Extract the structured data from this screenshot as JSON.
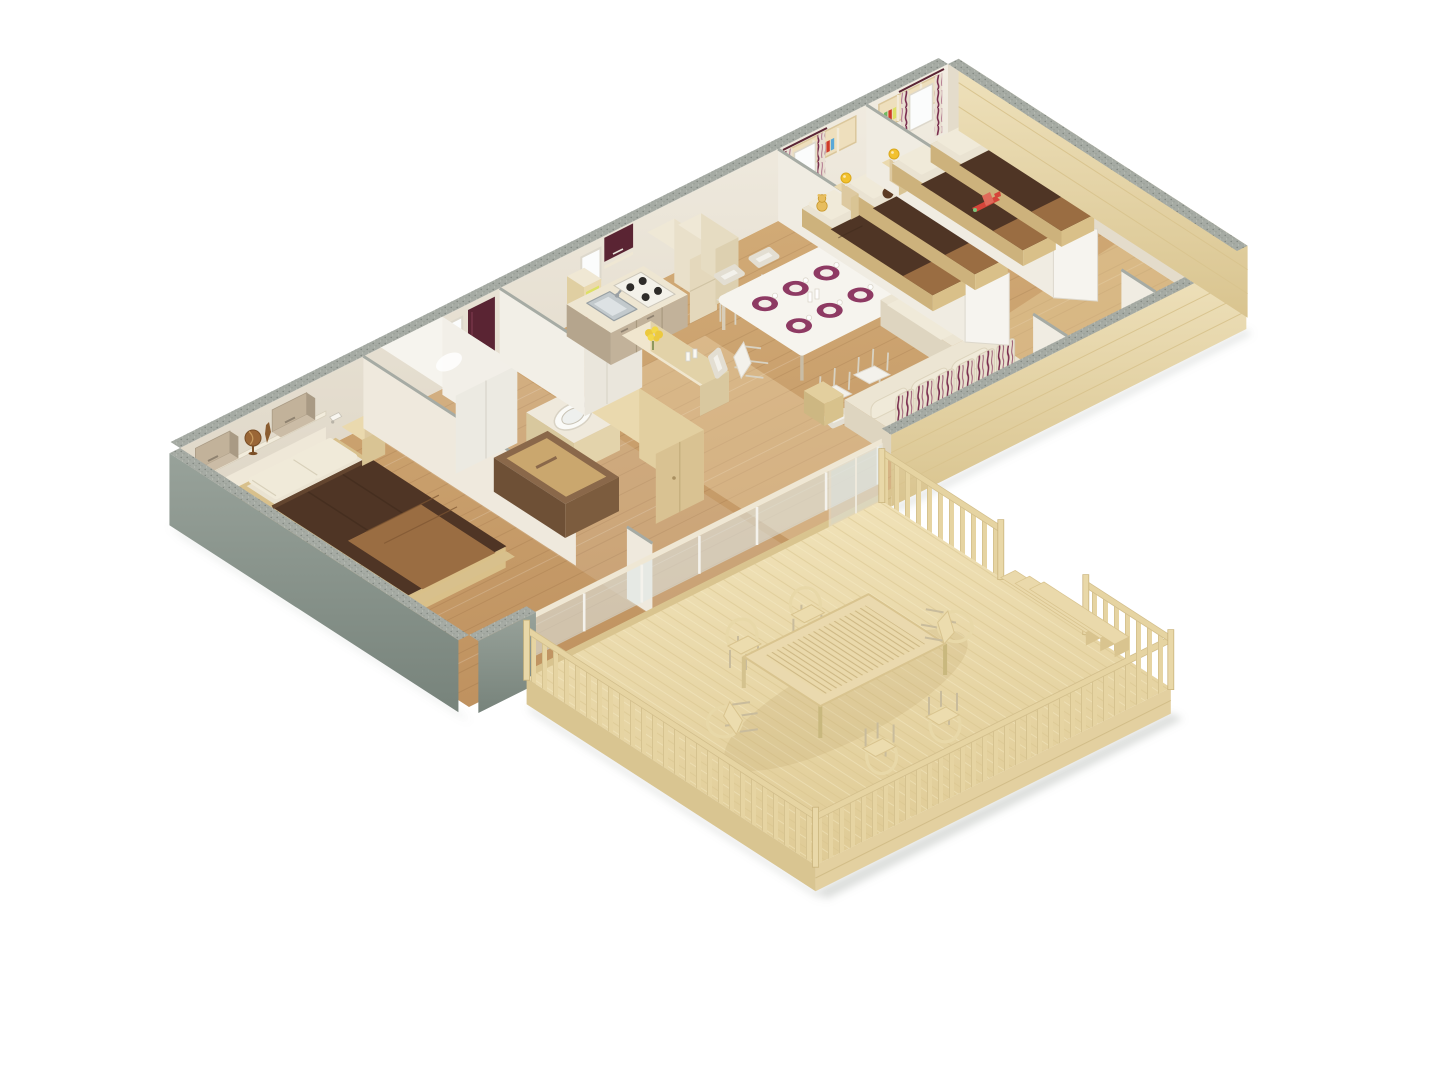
{
  "scene": {
    "title": "3d-floorplan-render-mobile-home",
    "background": "#ffffff",
    "counts": {
      "double_beds": 1,
      "single_beds": 4,
      "dining_plates": 6,
      "dining_chairs": 5,
      "terrace_chairs": 6,
      "bedrooms": 3
    },
    "rooms": [
      {
        "id": "master-bedroom",
        "items": [
          "double-bed",
          "brown-blanket",
          "tan-runner",
          "pillows-x2",
          "wall-cabinets-x2",
          "open-shelf",
          "globe",
          "reading-lamps-x2",
          "nightstand",
          "headboard"
        ]
      },
      {
        "id": "bathroom",
        "items": [
          "shower-cabin",
          "washbasin",
          "open-storage-cabinet",
          "tall-wardrobe",
          "window",
          "maroon-door"
        ]
      },
      {
        "id": "wc",
        "items": [
          "partition-walls"
        ]
      },
      {
        "id": "kitchen",
        "items": [
          "counter",
          "cooktop-4-burners",
          "sink",
          "maroon-wall-cabinet",
          "fridge-column",
          "tall-cabinet",
          "bar-counter",
          "yellow-flower-bouquet",
          "corner-shelf-red-books",
          "corner-shelf-yellow-books",
          "window"
        ]
      },
      {
        "id": "living-dining",
        "items": [
          "dining-table",
          "purple-plate-settings-x6",
          "white-chairs-x5",
          "corner-bench-sofa",
          "striped-back-cushions",
          "side-table",
          "sliding-glass-door"
        ]
      },
      {
        "id": "kids-bedroom-1",
        "items": [
          "single-beds-x2",
          "nightstand-with-lamp",
          "yellow-teddy",
          "brown-teddy",
          "wall-bookshelf",
          "curtained-window",
          "white-door"
        ]
      },
      {
        "id": "kids-bedroom-2",
        "items": [
          "single-beds-x2",
          "nightstand-with-lamp",
          "red-toy-plane",
          "wall-bookshelf",
          "curtained-window",
          "white-door"
        ]
      },
      {
        "id": "terrace",
        "items": [
          "wood-deck",
          "railing-balusters",
          "corner-posts",
          "steps",
          "slatted-outdoor-table",
          "outdoor-chairs-x6"
        ]
      }
    ],
    "palette": {
      "bg": "#ffffff",
      "floor_light": "#d8b37e",
      "floor_dark": "#bf9260",
      "wall_top": "#f2ede2",
      "wall_bot": "#ded6c6",
      "wall_partition": "#efe9dd",
      "wall_white": "#f2efe7",
      "gable_int": "#e4dccb",
      "wall_cut": "#a6aba4",
      "ext_green_light": "#98a29a",
      "ext_green_dark": "#77837b",
      "ext_wood_light": "#efe2bd",
      "ext_wood_dark": "#d9c48f",
      "deck_light": "#f2e4bb",
      "deck_dark": "#e0cc97",
      "deck_line": "#d8c48e",
      "rail_wood": "#e6d4a2",
      "bed_brown": "#4f3525",
      "bed_brown_hi": "#63452f",
      "bed_tan": "#9a6d42",
      "pillow": "#f0ead9",
      "mattress": "#eae3d2",
      "frame_wood": "#d8c08c",
      "sofa_base": "#ece5d3",
      "sofa_side": "#ded5c0",
      "cushion_bg": "#e9e1cf",
      "accent_maroon": "#7a2e4f",
      "maroon_dark": "#5a2433",
      "plate_purple": "#8e3a63",
      "table_white": "#f6f4ee",
      "chair_white": "#f3f1eb",
      "counter_top": "#eee6d2",
      "cabinet_taupe": "#c2b29a",
      "beige_wood": "#ead9ae",
      "beige_wood_dark": "#ddc9a0",
      "steel": "#c2c9cc",
      "burner": "#2e2c29",
      "lamp_yellow": "#f2c12e",
      "flower_yellow": "#ecc93e",
      "book_red": "#cf3a2a",
      "book_yellow": "#dde066",
      "book_blue": "#58a8d8",
      "book_green": "#70b860",
      "teddy_yellow": "#e7bd5e",
      "teddy_brown": "#5d3c24",
      "toy_red": "#d5453a",
      "curtain_bg": "#e9dfd2",
      "glass": "#dfe9ea",
      "shadow": "#8a938c"
    }
  }
}
